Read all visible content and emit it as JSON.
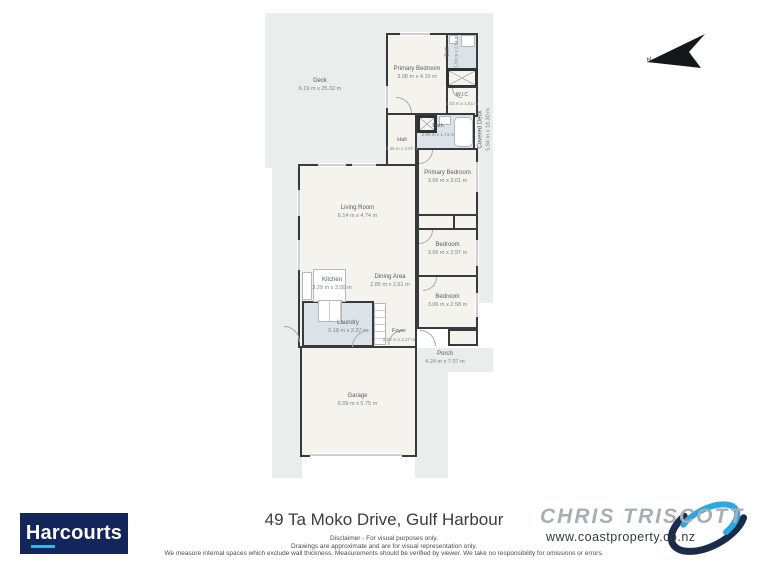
{
  "plan": {
    "north_label": "N",
    "rooms": {
      "deck": {
        "name": "Deck",
        "dims": "6.19 m x 25.32 m"
      },
      "covered_deck": {
        "name": "Covered Deck",
        "dims": "5.84 m x 18.30 m"
      },
      "primary_bedroom_1": {
        "name": "Primary Bedroom",
        "dims": "3.08 m x 4.10 m"
      },
      "ensuite_bath": {
        "name": "Bath",
        "dims": "1.50 m x 2.54 m"
      },
      "wic": {
        "name": "W.I.C",
        "dims": "1.03 m x 1.61 m"
      },
      "hall": {
        "name": "Hall",
        "dims": "1.35 m x 3.07 m"
      },
      "bath": {
        "name": "Bath",
        "dims": "2.06 m x 1.74 m"
      },
      "primary_bedroom_2": {
        "name": "Primary Bedroom",
        "dims": "3.06 m x 3.01 m"
      },
      "bedroom_1": {
        "name": "Bedroom",
        "dims": "3.06 m x 2.97 m"
      },
      "bedroom_2": {
        "name": "Bedroom",
        "dims": "3.06 m x 2.58 m"
      },
      "living_room": {
        "name": "Living Room",
        "dims": "6.14 m x 4.74 m"
      },
      "dining_area": {
        "name": "Dining Area",
        "dims": "2.85 m x 2.61 m"
      },
      "kitchen": {
        "name": "Kitchen",
        "dims": "3.29 m x 3.00 m"
      },
      "laundry": {
        "name": "Laundry",
        "dims": "5.18 m x 2.27 m"
      },
      "foyer": {
        "name": "Foyer",
        "dims": "2.00 m x 2.27 m"
      },
      "porch": {
        "name": "Porch",
        "dims": "4.24 m x 7.07 m"
      },
      "garage": {
        "name": "Garage",
        "dims": "6.09 m x 5.75 m"
      }
    }
  },
  "footer": {
    "address": "49 Ta Moko Drive, Gulf Harbour",
    "disclaimer_line1": "Disclaimer - For visual purposes only.",
    "disclaimer_line2": "Drawings are approximate and are for visual representation only.",
    "disclaimer_line3": "We measure internal spaces which exclude wall thickness. Measurements should be verified by viewer. We take no responsibility for omissions or errors.",
    "harcourts_logo": "Harcourts",
    "agent_logo": "CHRIS TRISCOTT",
    "agent_website": "www.coastproperty.co.nz",
    "colors": {
      "harcourts_navy": "#13265b",
      "harcourts_cyan": "#3fb3e4",
      "swoosh_blue": "#2aa9e0",
      "swoosh_navy": "#1b2b49",
      "wall": "#383b3e",
      "wet_room": "#dbe3e9",
      "outdoor_gray": "#ebecec",
      "room_cream": "#f5f3ee"
    }
  }
}
